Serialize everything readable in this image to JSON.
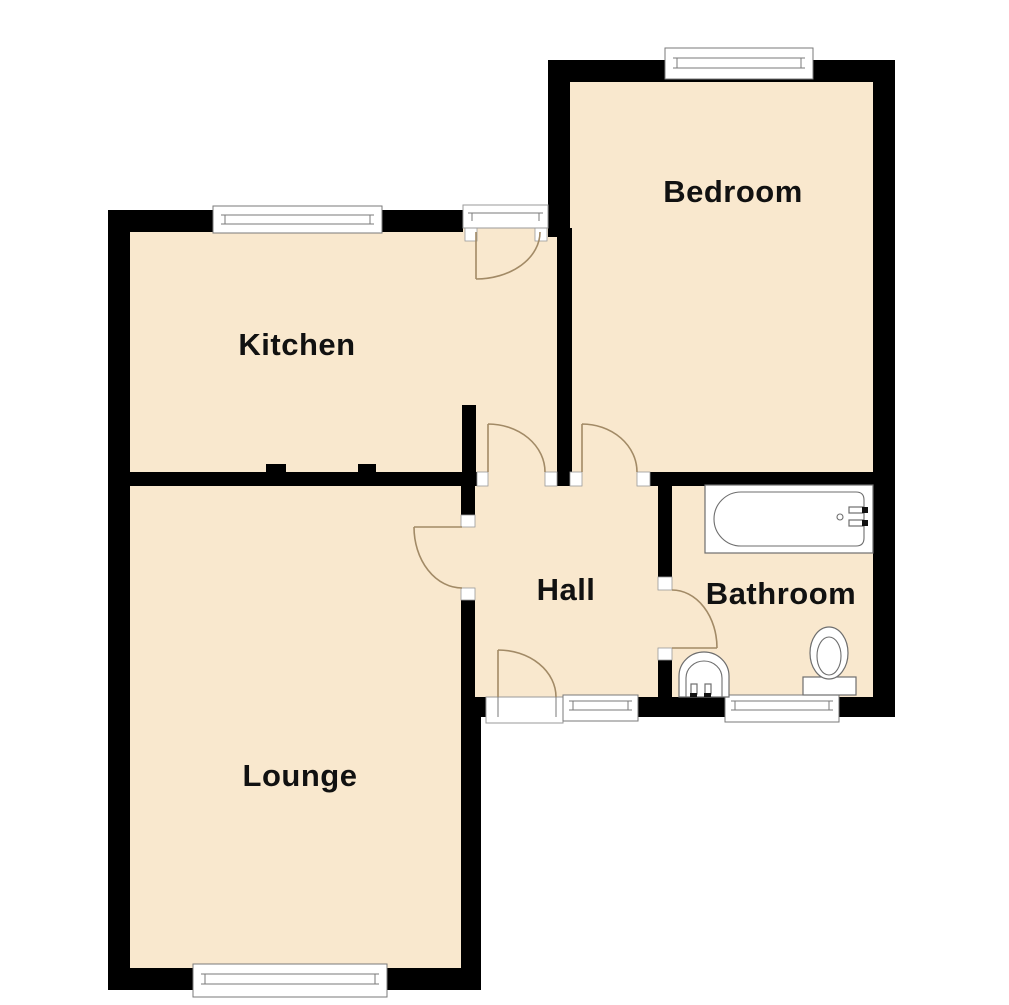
{
  "plan": {
    "type": "floor-plan",
    "rooms": {
      "bedroom": {
        "label": "Bedroom"
      },
      "kitchen": {
        "label": "Kitchen"
      },
      "hall": {
        "label": "Hall"
      },
      "bathroom": {
        "label": "Bathroom"
      },
      "lounge": {
        "label": "Lounge"
      }
    },
    "fixtures": [
      {
        "name": "bathtub",
        "room": "bathroom"
      },
      {
        "name": "washbasin",
        "room": "bathroom"
      },
      {
        "name": "toilet",
        "room": "bathroom"
      }
    ]
  },
  "colors": {
    "background": "#FFFFFF",
    "wall": "#000000",
    "floor": "#F9E8CE",
    "door_arc": "#A28A66",
    "window_frame": "#7a7a7a",
    "fixture_outline": "#6e6e6e",
    "label": "#111111"
  }
}
